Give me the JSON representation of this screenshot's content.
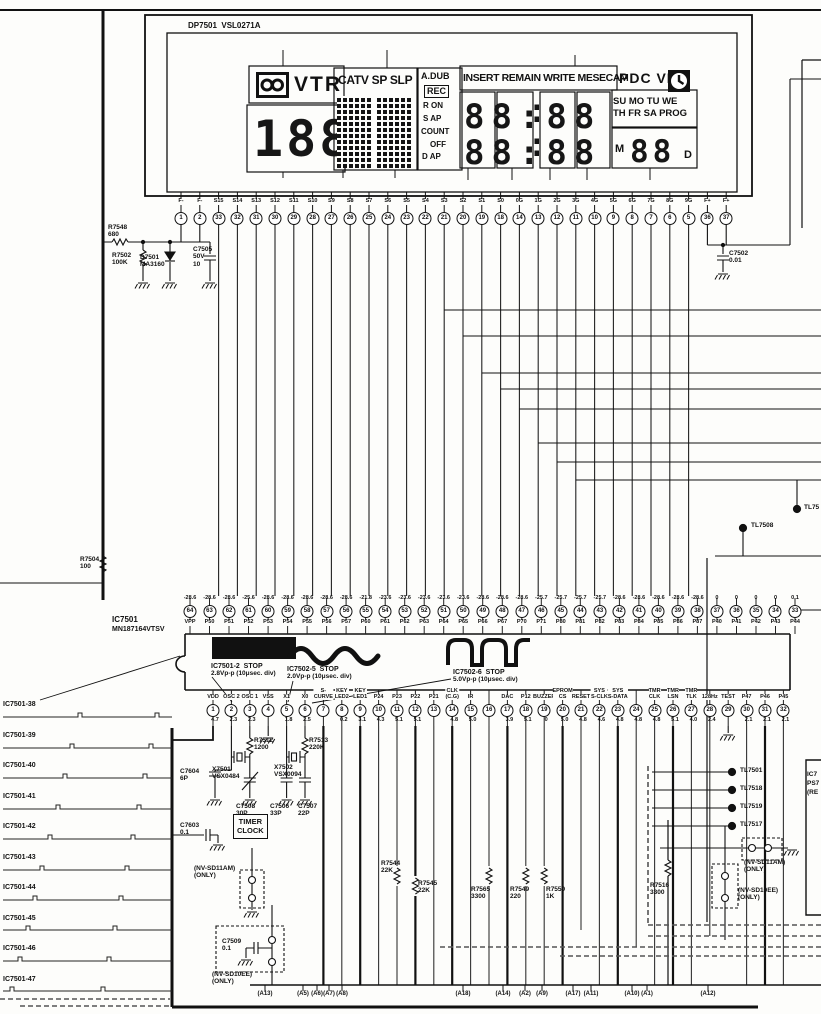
{
  "display": {
    "part": "DP7501  VSL0271A",
    "vtr": "VTR",
    "counter": "188",
    "modes": "CATV SP SLP",
    "adub": "A.DUB",
    "rec": "REC",
    "flags": [
      "R ON",
      "S AP",
      "COUNT",
      "OFF",
      "D AP"
    ],
    "insert": "INSERT REMAIN WRITE MESECAM",
    "pdc": "PDC VPS",
    "days1": "SU MO TU WE",
    "days2": "TH FR SA PROG",
    "clock1": "88:88",
    "clock2": "88:88",
    "m": "M",
    "date": "88",
    "d": "D",
    "group_top": [
      {
        "t": "4G",
        "x": 283
      },
      {
        "t": "5G",
        "x": 387
      },
      {
        "t": "9G",
        "x": 575
      }
    ],
    "group_bottom": [
      {
        "t": "8G",
        "x": 283
      },
      {
        "t": "7G",
        "x": 343
      },
      {
        "t": "6G",
        "x": 395
      },
      {
        "t": "4G",
        "x": 468
      },
      {
        "t": "3G",
        "x": 512
      },
      {
        "t": "2G",
        "x": 550
      },
      {
        "t": "1G",
        "x": 587
      },
      {
        "t": "0G",
        "x": 650
      }
    ]
  },
  "lcd_pins": [
    {
      "name": "F-",
      "num": "1"
    },
    {
      "name": "F-",
      "num": "2"
    },
    {
      "name": "S15",
      "num": "33"
    },
    {
      "name": "S14",
      "num": "32"
    },
    {
      "name": "S13",
      "num": "31"
    },
    {
      "name": "S12",
      "num": "30"
    },
    {
      "name": "S11",
      "num": "29"
    },
    {
      "name": "S10",
      "num": "28"
    },
    {
      "name": "S9",
      "num": "27"
    },
    {
      "name": "S8",
      "num": "26"
    },
    {
      "name": "S7",
      "num": "25"
    },
    {
      "name": "S6",
      "num": "24"
    },
    {
      "name": "S5",
      "num": "23"
    },
    {
      "name": "S4",
      "num": "22"
    },
    {
      "name": "S3",
      "num": "21"
    },
    {
      "name": "S2",
      "num": "20"
    },
    {
      "name": "S1",
      "num": "19"
    },
    {
      "name": "S0",
      "num": "18"
    },
    {
      "name": "0G",
      "num": "14"
    },
    {
      "name": "1G",
      "num": "13"
    },
    {
      "name": "2G",
      "num": "12"
    },
    {
      "name": "3G",
      "num": "11"
    },
    {
      "name": "4G",
      "num": "10"
    },
    {
      "name": "5G",
      "num": "9"
    },
    {
      "name": "6G",
      "num": "8"
    },
    {
      "name": "7G",
      "num": "7"
    },
    {
      "name": "8G",
      "num": "6"
    },
    {
      "name": "9G",
      "num": "5"
    },
    {
      "name": "F+",
      "num": "36"
    },
    {
      "name": "F+",
      "num": "37"
    }
  ],
  "ic": {
    "ref": "IC7501",
    "part": "MN187164VTSV",
    "top": [
      {
        "name": "VPP",
        "num": "64",
        "volt": "-28.6"
      },
      {
        "name": "P50",
        "num": "63",
        "volt": "-28.6"
      },
      {
        "name": "P51",
        "num": "62",
        "volt": "-28.6"
      },
      {
        "name": "P52",
        "num": "61",
        "volt": "-25.6"
      },
      {
        "name": "P53",
        "num": "60",
        "volt": "-28.6"
      },
      {
        "name": "P54",
        "num": "59",
        "volt": "-28.6"
      },
      {
        "name": "P55",
        "num": "58",
        "volt": "-28.6"
      },
      {
        "name": "P56",
        "num": "57",
        "volt": "-28.6"
      },
      {
        "name": "P57",
        "num": "56",
        "volt": "-28.6"
      },
      {
        "name": "P60",
        "num": "55",
        "volt": "-21.8"
      },
      {
        "name": "P61",
        "num": "54",
        "volt": "-23.6"
      },
      {
        "name": "P62",
        "num": "53",
        "volt": "-23.6"
      },
      {
        "name": "P63",
        "num": "52",
        "volt": "-23.6"
      },
      {
        "name": "P64",
        "num": "51",
        "volt": "-23.6"
      },
      {
        "name": "P65",
        "num": "50",
        "volt": "-23.6"
      },
      {
        "name": "P66",
        "num": "49",
        "volt": "-28.6"
      },
      {
        "name": "P67",
        "num": "48",
        "volt": "-28.6"
      },
      {
        "name": "P70",
        "num": "47",
        "volt": "-28.6"
      },
      {
        "name": "P71",
        "num": "46",
        "volt": "-25.7"
      },
      {
        "name": "P80",
        "num": "45",
        "volt": "-25.7"
      },
      {
        "name": "P81",
        "num": "44",
        "volt": "-25.7"
      },
      {
        "name": "P82",
        "num": "43",
        "volt": "-25.7"
      },
      {
        "name": "P83",
        "num": "42",
        "volt": "-28.6"
      },
      {
        "name": "P84",
        "num": "41",
        "volt": "-28.6"
      },
      {
        "name": "P85",
        "num": "40",
        "volt": "-28.6"
      },
      {
        "name": "P86",
        "num": "39",
        "volt": "-28.6"
      },
      {
        "name": "P87",
        "num": "38",
        "volt": "-28.6"
      },
      {
        "name": "P40",
        "num": "37",
        "volt": "0"
      },
      {
        "name": "P41",
        "num": "36",
        "volt": "0"
      },
      {
        "name": "P42",
        "num": "35",
        "volt": "0"
      },
      {
        "name": "P43",
        "num": "34",
        "volt": "0"
      },
      {
        "name": "P44",
        "num": "33",
        "volt": "0.1"
      }
    ],
    "bottom": [
      {
        "name": "VDD",
        "num": "1",
        "volt": "4.7"
      },
      {
        "name": "OSC 2",
        "num": "2",
        "volt": "2.3"
      },
      {
        "name": "OSC 1",
        "num": "3",
        "volt": "2.3"
      },
      {
        "name": "VSS",
        "num": "4",
        "volt": ""
      },
      {
        "name": "X1",
        "num": "5",
        "volt": "1.8"
      },
      {
        "name": "X0",
        "num": "6",
        "volt": "2.5"
      },
      {
        "name": "S-\nCURVE",
        "num": "7",
        "volt": ""
      },
      {
        "name": "KEY\nLED2",
        "num": "8",
        "volt": "0.2"
      },
      {
        "name": "KEY\nLED1",
        "num": "9",
        "volt": "3.1"
      },
      {
        "name": "P24",
        "num": "10",
        "volt": "4.3"
      },
      {
        "name": "P23",
        "num": "11",
        "volt": "5.1"
      },
      {
        "name": "P22",
        "num": "12",
        "volt": "5.1"
      },
      {
        "name": "P21",
        "num": "13",
        "volt": ""
      },
      {
        "name": "CLK\n(C.G)",
        "num": "14",
        "volt": "4.8"
      },
      {
        "name": "IR",
        "num": "15",
        "volt": "5.0"
      },
      {
        "name": "",
        "num": "16",
        "volt": ""
      },
      {
        "name": "DAC",
        "num": "17",
        "volt": "3.9"
      },
      {
        "name": "P12",
        "num": "18",
        "volt": "5.1"
      },
      {
        "name": "BUZZER",
        "num": "19",
        "volt": "0"
      },
      {
        "name": "EPROM\nCS",
        "num": "20",
        "volt": "5.0"
      },
      {
        "name": "RESET",
        "num": "21",
        "volt": "4.8"
      },
      {
        "name": "SYS\nS-CLK",
        "num": "22",
        "volt": "4.6"
      },
      {
        "name": "SYS\nS-DATA",
        "num": "23",
        "volt": "4.8"
      },
      {
        "name": "",
        "num": "24",
        "volt": "4.8"
      },
      {
        "name": "TMR\nCLK",
        "num": "25",
        "volt": "4.8"
      },
      {
        "name": "TMR\nLSN",
        "num": "26",
        "volt": "5.1"
      },
      {
        "name": "TMR\nTLK",
        "num": "27",
        "volt": "4.0"
      },
      {
        "name": "128Hz",
        "num": "28",
        "volt": "2.4"
      },
      {
        "name": "TEST",
        "num": "29",
        "volt": ""
      },
      {
        "name": "P47",
        "num": "30",
        "volt": "2.1"
      },
      {
        "name": "P46",
        "num": "31",
        "volt": "2.1"
      },
      {
        "name": "P45",
        "num": "32",
        "volt": "2.1"
      }
    ]
  },
  "waveforms": [
    {
      "title": "IC7501-2  STOP",
      "spec": "2.8Vp-p (10μsec. div)",
      "x": 211,
      "y": 663
    },
    {
      "title": "IC7502-5  STOP",
      "spec": "2.0Vp-p (10μsec. div)",
      "x": 287,
      "y": 666
    },
    {
      "title": "IC7502-6  STOP",
      "spec": "5.0Vp-p (10μsec. div)",
      "x": 453,
      "y": 669
    }
  ],
  "left_signals": [
    "IC7501-38",
    "IC7501-39",
    "IC7501-40",
    "IC7501-41",
    "IC7501-42",
    "IC7501-43",
    "IC7501-44",
    "IC7501-45",
    "IC7501-46",
    "IC7501-47"
  ],
  "components": [
    {
      "t": "R7548\n680",
      "x": 108,
      "y": 224
    },
    {
      "t": "R7502\n100K",
      "x": 112,
      "y": 252
    },
    {
      "t": "D7501\nMA3160",
      "x": 140,
      "y": 254
    },
    {
      "t": "C7505\n50V\n10",
      "x": 193,
      "y": 246
    },
    {
      "t": "C7502\n0.01",
      "x": 729,
      "y": 250
    },
    {
      "t": "R7504\n100",
      "x": 80,
      "y": 556
    },
    {
      "t": "R7512\n1200",
      "x": 254,
      "y": 737
    },
    {
      "t": "R7513\n220K",
      "x": 309,
      "y": 737
    },
    {
      "t": "X7501\nVSX0484",
      "x": 212,
      "y": 766
    },
    {
      "t": "X7502\nVSX0094",
      "x": 274,
      "y": 764
    },
    {
      "t": "C7604\n6P",
      "x": 180,
      "y": 768
    },
    {
      "t": "C7508\n30P",
      "x": 236,
      "y": 803
    },
    {
      "t": "C7506\n33P",
      "x": 270,
      "y": 803
    },
    {
      "t": "C7507\n22P",
      "x": 298,
      "y": 803
    },
    {
      "t": "C7603\n0.1",
      "x": 180,
      "y": 822
    },
    {
      "t": "C7509\n0.1",
      "x": 222,
      "y": 938
    },
    {
      "t": "R7544\n22K",
      "x": 381,
      "y": 860
    },
    {
      "t": "R7545\n22K",
      "x": 418,
      "y": 880
    },
    {
      "t": "R7565\n3300",
      "x": 471,
      "y": 886
    },
    {
      "t": "R7549\n220",
      "x": 510,
      "y": 886
    },
    {
      "t": "R7550\n1K",
      "x": 546,
      "y": 886
    },
    {
      "t": "R7516\n3300",
      "x": 650,
      "y": 882
    }
  ],
  "timer_clock": "TIMER\nCLOCK",
  "option_notes": [
    {
      "t": "(NV-SD11AM)\n(ONLY)",
      "x": 194,
      "y": 866
    },
    {
      "t": "(NV-SD10EE)\n(ONLY)",
      "x": 212,
      "y": 972
    },
    {
      "t": "(NV-SD11AM)\n(ONLY)",
      "x": 744,
      "y": 860
    },
    {
      "t": "(NV-SD10EE)\n(ONLY)",
      "x": 738,
      "y": 888
    }
  ],
  "test_points": [
    {
      "t": "TL7501",
      "x": 740,
      "y": 768
    },
    {
      "t": "TL7518",
      "x": 740,
      "y": 786
    },
    {
      "t": "TL7519",
      "x": 740,
      "y": 804
    },
    {
      "t": "TL7517",
      "x": 740,
      "y": 822
    },
    {
      "t": "TL7508",
      "x": 751,
      "y": 523
    },
    {
      "t": "TL75",
      "x": 804,
      "y": 505
    }
  ],
  "right_partials": [
    "IC7",
    "PS7",
    "(RE"
  ],
  "connectors": [
    {
      "t": "(A13)",
      "x": 265
    },
    {
      "t": "(A5)",
      "x": 303
    },
    {
      "t": "(A6)",
      "x": 317
    },
    {
      "t": "(A7)",
      "x": 329
    },
    {
      "t": "(A8)",
      "x": 342
    },
    {
      "t": "(A18)",
      "x": 463
    },
    {
      "t": "(A14)",
      "x": 503
    },
    {
      "t": "(A2)",
      "x": 525
    },
    {
      "t": "(A9)",
      "x": 542
    },
    {
      "t": "(A17)",
      "x": 573
    },
    {
      "t": "(A11)",
      "x": 591
    },
    {
      "t": "(A10)",
      "x": 632
    },
    {
      "t": "(A1)",
      "x": 647
    },
    {
      "t": "(A12)",
      "x": 708
    }
  ]
}
